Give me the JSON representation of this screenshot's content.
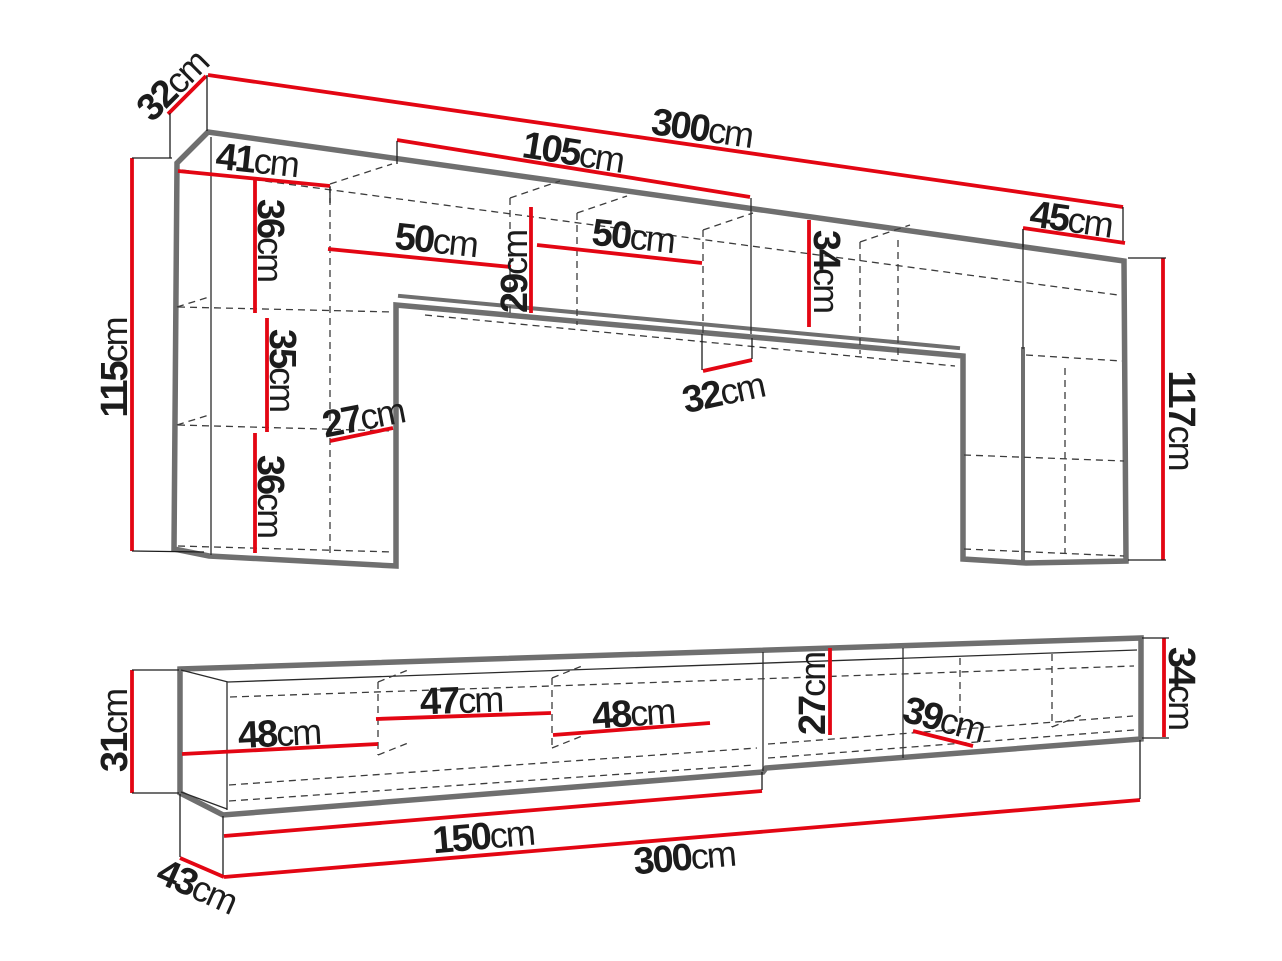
{
  "colors": {
    "dimension_red": "#e30613",
    "outline_gray": "#6f6f6f",
    "line_black": "#1c1c1c",
    "background": "#ffffff"
  },
  "wall_unit": {
    "dims": {
      "top_depth": {
        "value": "32",
        "unit": "cm"
      },
      "total_width": {
        "value": "300",
        "unit": "cm"
      },
      "bridge_left_width": {
        "value": "105",
        "unit": "cm"
      },
      "left_top_width": {
        "value": "41",
        "unit": "cm"
      },
      "top_shelf_height": {
        "value": "36",
        "unit": "cm"
      },
      "left_compartment_width": {
        "value": "50",
        "unit": "cm"
      },
      "inner_height": {
        "value": "29",
        "unit": "cm"
      },
      "right_compartment_width": {
        "value": "50",
        "unit": "cm"
      },
      "bridge_height": {
        "value": "34",
        "unit": "cm"
      },
      "right_top_width": {
        "value": "45",
        "unit": "cm"
      },
      "left_height": {
        "value": "115",
        "unit": "cm"
      },
      "middle_shelf_height": {
        "value": "35",
        "unit": "cm"
      },
      "shelf_depth": {
        "value": "27",
        "unit": "cm"
      },
      "bridge_depth": {
        "value": "32",
        "unit": "cm"
      },
      "bottom_shelf_height": {
        "value": "36",
        "unit": "cm"
      },
      "right_height": {
        "value": "117",
        "unit": "cm"
      }
    }
  },
  "tv_stand": {
    "dims": {
      "left_height": {
        "value": "31",
        "unit": "cm"
      },
      "compartment1_width": {
        "value": "48",
        "unit": "cm"
      },
      "compartment2_width": {
        "value": "47",
        "unit": "cm"
      },
      "compartment3_width": {
        "value": "48",
        "unit": "cm"
      },
      "inner_height": {
        "value": "27",
        "unit": "cm"
      },
      "right_compartment_depth": {
        "value": "39",
        "unit": "cm"
      },
      "right_height": {
        "value": "34",
        "unit": "cm"
      },
      "left_section_width": {
        "value": "150",
        "unit": "cm"
      },
      "total_width": {
        "value": "300",
        "unit": "cm"
      },
      "depth": {
        "value": "43",
        "unit": "cm"
      }
    }
  }
}
